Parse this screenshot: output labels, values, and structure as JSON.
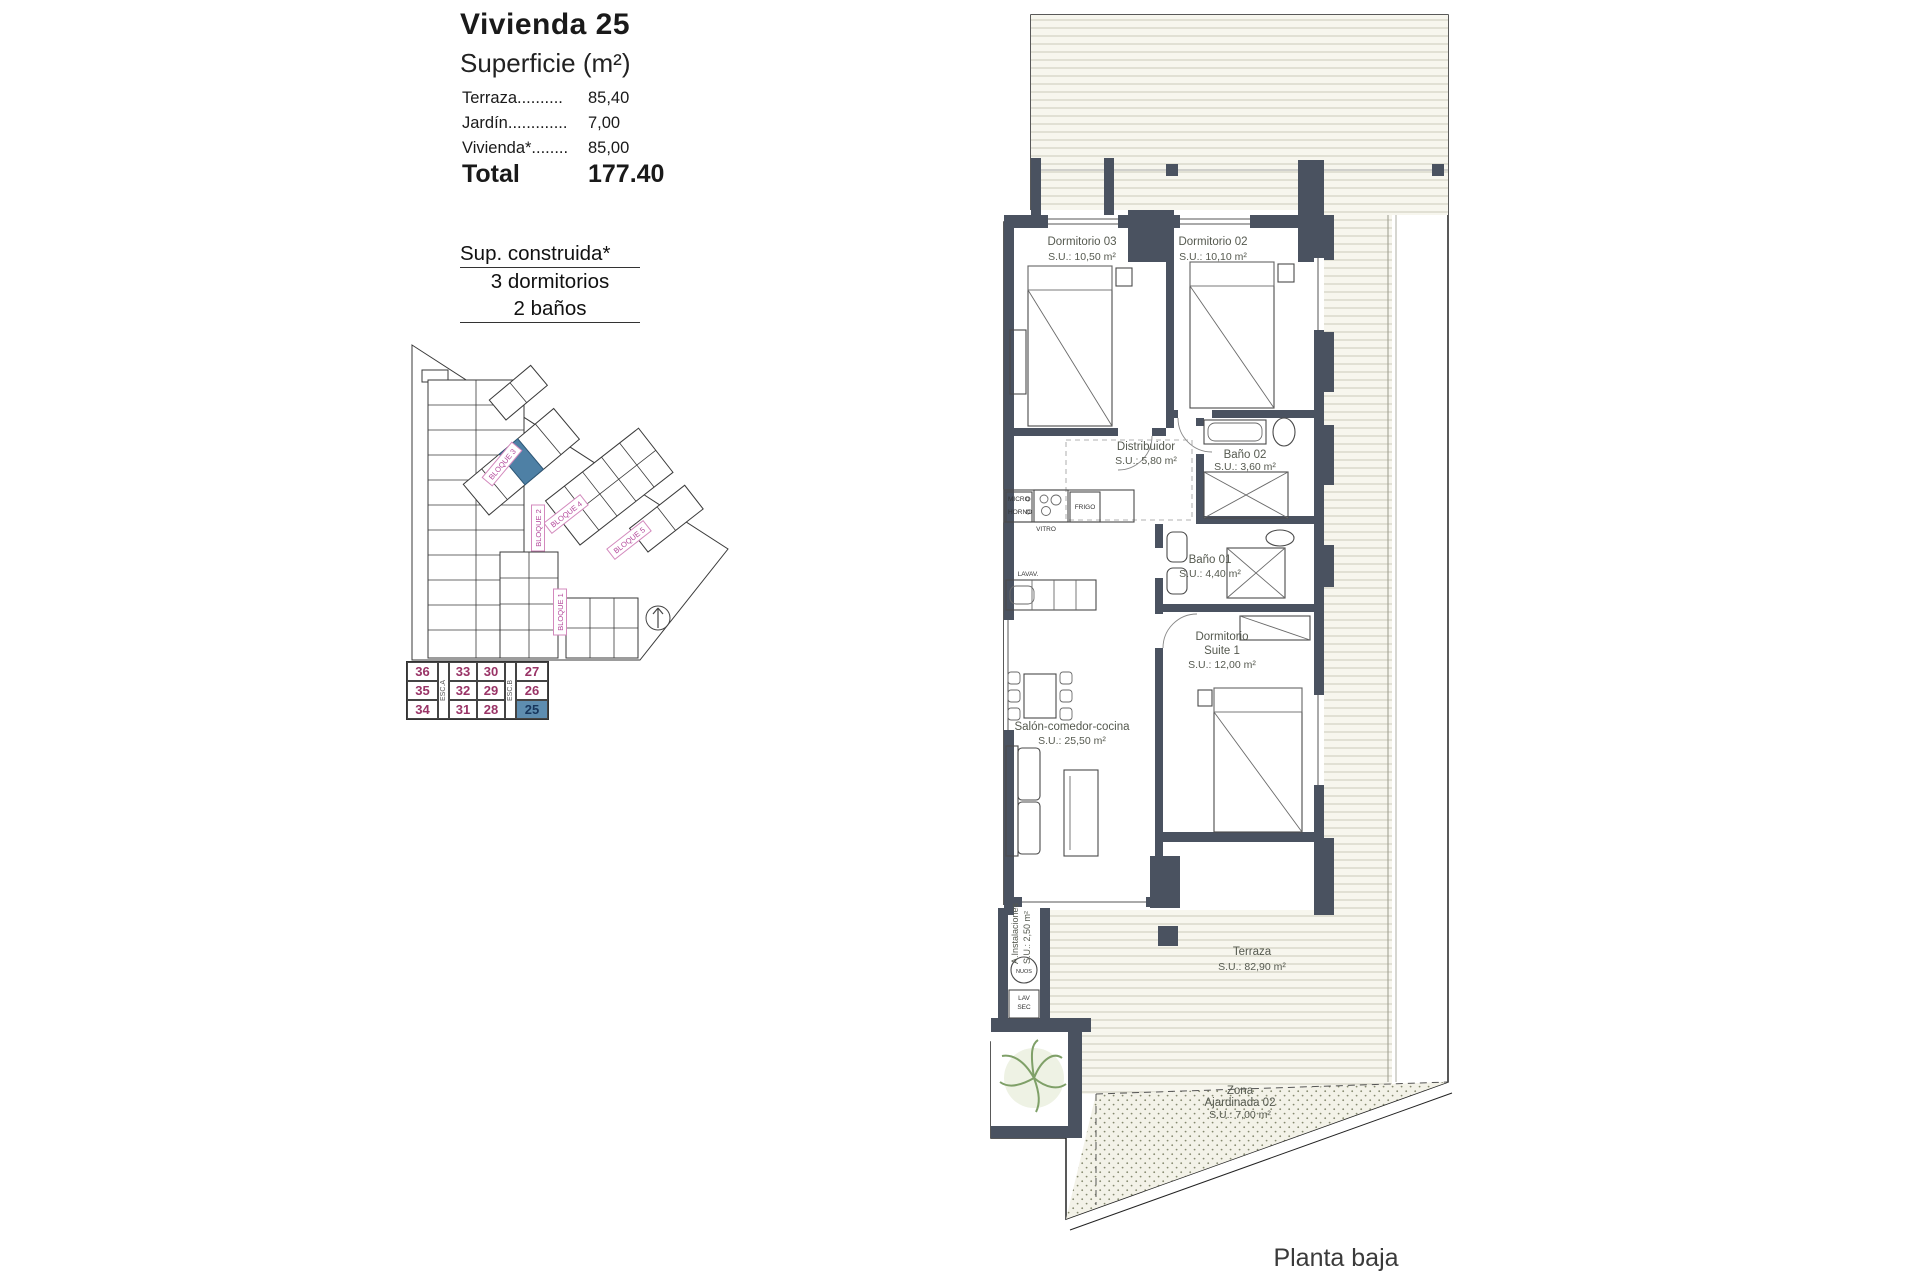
{
  "info": {
    "title": "Vivienda 25",
    "subtitle": "Superficie (m²)",
    "rows": [
      {
        "label": "Terraza..........",
        "value": "85,40"
      },
      {
        "label": "Jardín.............",
        "value": "7,00"
      },
      {
        "label": "Vivienda*........",
        "value": "85,00"
      }
    ],
    "total_label": "Total",
    "total_value": "177.40",
    "built_title": "Sup. construida*",
    "built_lines": [
      "3 dormitorios",
      "2 baños"
    ]
  },
  "unit_table": {
    "title": "BLOQUE 3",
    "esc_a": "ESC.A",
    "esc_b": "ESC.B",
    "rows": [
      [
        "36",
        "33",
        "30",
        "27"
      ],
      [
        "35",
        "32",
        "29",
        "26"
      ],
      [
        "34",
        "31",
        "28",
        "25"
      ]
    ],
    "selected": "25",
    "number_color": "#993366",
    "selected_bg": "#5e8db0"
  },
  "sitemap": {
    "labels": {
      "b1": "BLOQUE 1",
      "b2": "BLOQUE 2",
      "b3": "BLOQUE 3",
      "b4": "BLOQUE 4",
      "b5": "BLOQUE 5"
    },
    "highlight_color": "#4e80a5"
  },
  "plan": {
    "rooms": {
      "dorm03": {
        "name": "Dormitorio 03",
        "area": "S.U.: 10,50 m²"
      },
      "dorm02": {
        "name": "Dormitorio 02",
        "area": "S.U.: 10,10 m²"
      },
      "distribuidor": {
        "name": "Distribuidor",
        "area": "S.U.: 5,80 m²"
      },
      "bano02": {
        "name": "Baño 02",
        "area": "S.U.: 3,60 m²"
      },
      "bano01": {
        "name": "Baño 01",
        "area": "S.U.: 4,40 m²"
      },
      "suite": {
        "name": "Dormitorio",
        "name2": "Suite 1",
        "area": "S.U.: 12,00 m²"
      },
      "salon": {
        "name": "Salón-comedor-cocina",
        "area": "S.U.: 25,50 m²"
      },
      "instalaciones": {
        "name": "A.Instalaciones",
        "area": "S.U.: 2,50 m²"
      },
      "terraza": {
        "name": "Terraza",
        "area": "S.U.: 82,90 m²"
      },
      "jardin": {
        "name": "Zona",
        "name2": "Ajardinada 02",
        "area": "S.U.: 7,00 m²"
      }
    },
    "appliances": {
      "micro": "MICRO",
      "horno": "HORNO",
      "vitro": "VITRO",
      "frigo": "FRIGO",
      "lavav": "LAVAV.",
      "nuos": "NUOS",
      "lav": "LAV",
      "sec": "SEC"
    },
    "caption": "Planta baja"
  }
}
